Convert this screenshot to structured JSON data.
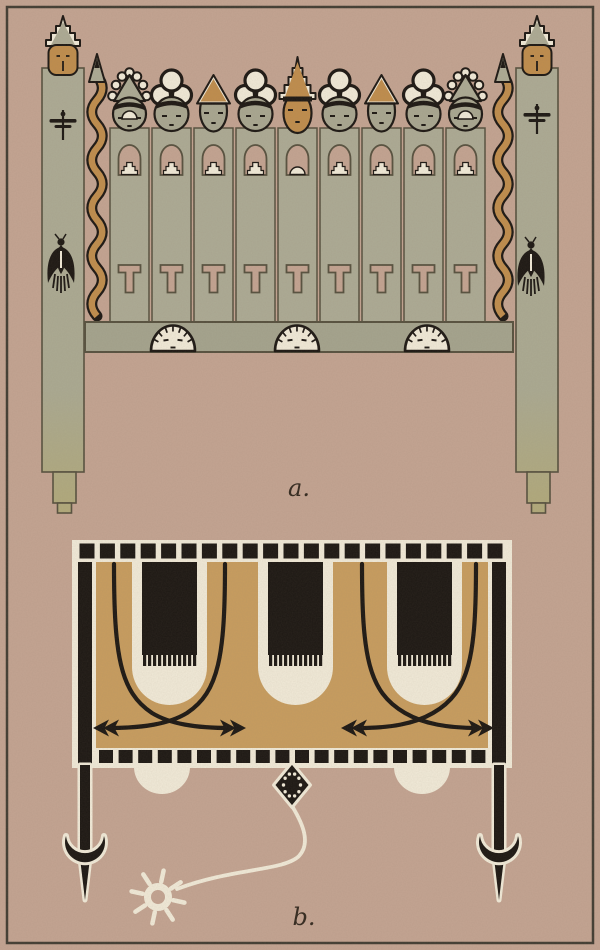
{
  "plate": {
    "figure_a_label": "a.",
    "figure_b_label": "b."
  },
  "colors": {
    "paper": "#c4a492",
    "ink": "#1c1713",
    "cream": "#f2ebd9",
    "slat_green": "#adab95",
    "board_green": "#a5a48e",
    "face_green": "#a9a791",
    "post_olive": "#b2aa7a",
    "ochre": "#c08d4d",
    "panel_tan": "#c89d5f",
    "outline": "#57513f",
    "label_ink": "#33291f"
  },
  "figure_a": {
    "label": "a.",
    "slat_count": 9,
    "slat_head_types": [
      "crown-circles",
      "cloud-trefoil",
      "triangle-cap",
      "cloud-trefoil",
      "zigzag-crown",
      "cloud-trefoil",
      "triangle-cap",
      "cloud-trefoil",
      "crown-circles"
    ],
    "board_face_count": 3,
    "board_face_centers": [
      173,
      297,
      427
    ],
    "icons": [
      "post-kachina-head-icon",
      "dragonfly-icon",
      "bird-icon",
      "snake-arrow-icon",
      "arch-niche-icon",
      "ziggurat-icon",
      "t-mark-icon",
      "board-face-icon"
    ]
  },
  "figure_b": {
    "label": "b.",
    "top_square_count": 21,
    "bottom_square_count": 20,
    "u_motif_count": 3,
    "u_motif_centers": [
      169.5,
      295.5,
      424.5
    ],
    "arrow_unit_centers": [
      169.5,
      424.5
    ],
    "teeth_per_motif": 11,
    "kite_dot_count": 10,
    "sun_ray_count": 8,
    "icons": [
      "rain-cloud-motif-icon",
      "whirlwind-arrow-icon",
      "kite-diamond-icon",
      "sun-icon",
      "crescent-foot-icon",
      "cloud-bump-icon"
    ]
  }
}
